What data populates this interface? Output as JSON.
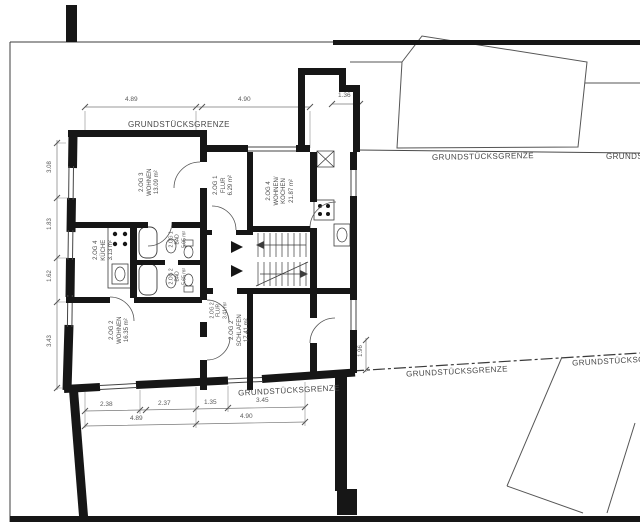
{
  "plan": {
    "boundary_label": "GRUNDSTÜCKSGRENZE",
    "rooms": [
      {
        "id": "2.OG 3",
        "name": "WOHNEN",
        "area": "13.09 m²"
      },
      {
        "id": "2.OG 1",
        "name": "FLUR",
        "area": "6.29 m²"
      },
      {
        "id": "2.OG 4",
        "name": "WOHNEN/",
        "name2": "KOCHEN",
        "area": "21.87 m²"
      },
      {
        "id": "2.OG 4",
        "name": "KÜCHE",
        "area": "3.13 m²"
      },
      {
        "id": "2.OG 1",
        "name": "BAD",
        "area": "5.05 m²"
      },
      {
        "id": "2.OG 2",
        "name": "BAD",
        "area": "5.65 m²"
      },
      {
        "id": "2.OG 2",
        "name": "WOHNEN",
        "area": "16.35 m²"
      },
      {
        "id": "2.OG 2",
        "name": "SCHLAFEN",
        "area": "17.41 m²"
      },
      {
        "id": "2.OG 2",
        "name": "FLUR",
        "area": "3.41 m²"
      }
    ],
    "dims": {
      "top": [
        "4.89",
        "4.90",
        "1.36"
      ],
      "bottom": [
        "2.38",
        "2.37",
        "1.35",
        "3.45"
      ],
      "bottom_totals": [
        "4.89",
        "4.90"
      ],
      "left": [
        "3.08",
        "1.83",
        "1.62",
        "3.43"
      ],
      "right": [
        "1.96"
      ]
    }
  }
}
